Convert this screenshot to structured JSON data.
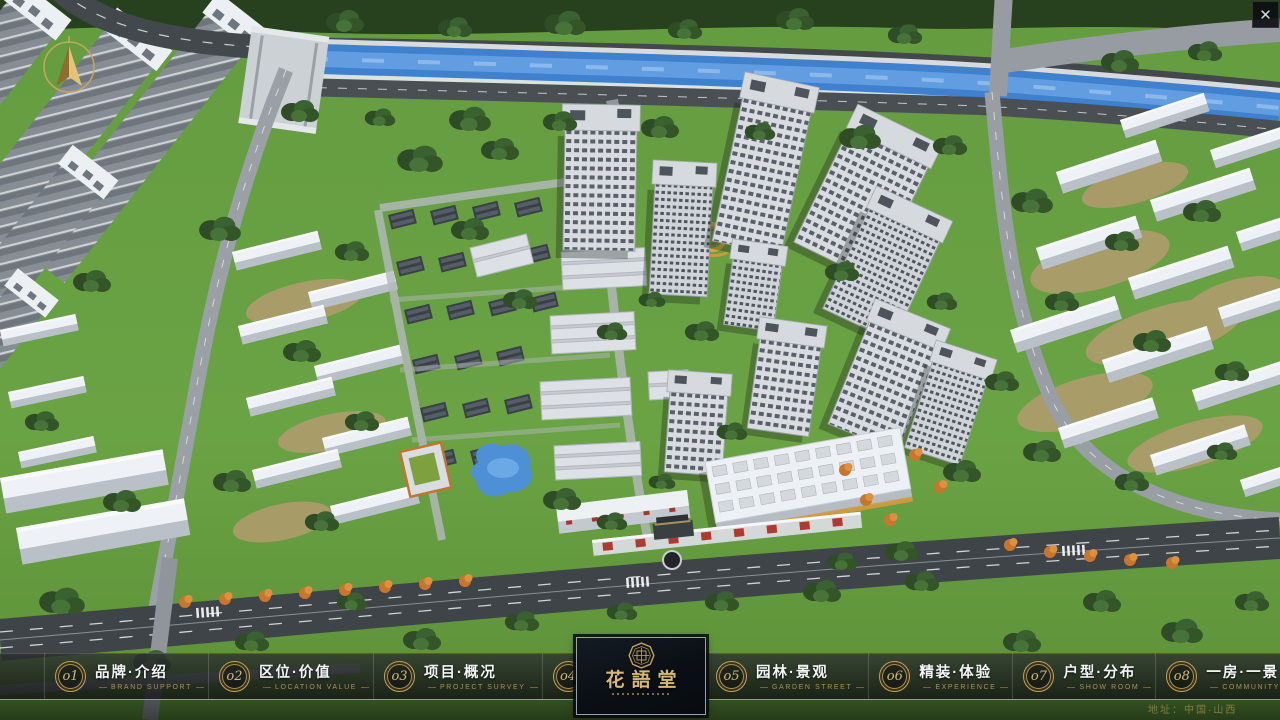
{
  "window": {
    "close_glyph": "✕"
  },
  "compass": {
    "icon": "north-arrow-compass"
  },
  "nav": {
    "items": [
      {
        "num": "o1",
        "zh": "品牌·介绍",
        "en": "BRAND SUPPORT"
      },
      {
        "num": "o2",
        "zh": "区位·价值",
        "en": "LOCATION VALUE"
      },
      {
        "num": "o3",
        "zh": "项目·概况",
        "en": "PROJECT SURVEY"
      },
      {
        "num": "o4",
        "zh": "建筑·鉴赏",
        "en": "APPRECIATION"
      },
      {
        "num": "o5",
        "zh": "园林·景观",
        "en": "GARDEN STREET"
      },
      {
        "num": "o6",
        "zh": "精装·体验",
        "en": "EXPERIENCE"
      },
      {
        "num": "o7",
        "zh": "户型·分布",
        "en": "SHOW ROOM"
      },
      {
        "num": "o8",
        "zh": "一房·一景",
        "en": "COMMUNITY"
      }
    ]
  },
  "logo": {
    "title": "花語堂"
  },
  "footer": {
    "address": "地址：中国·山西"
  },
  "colors": {
    "gold": "#c3a05c",
    "bar_border_gold": "#be9e54",
    "nav_text": "#f4f5f6",
    "nav_caption": "#ac9158",
    "river": "#3f80cf",
    "grass": "#69a143"
  }
}
